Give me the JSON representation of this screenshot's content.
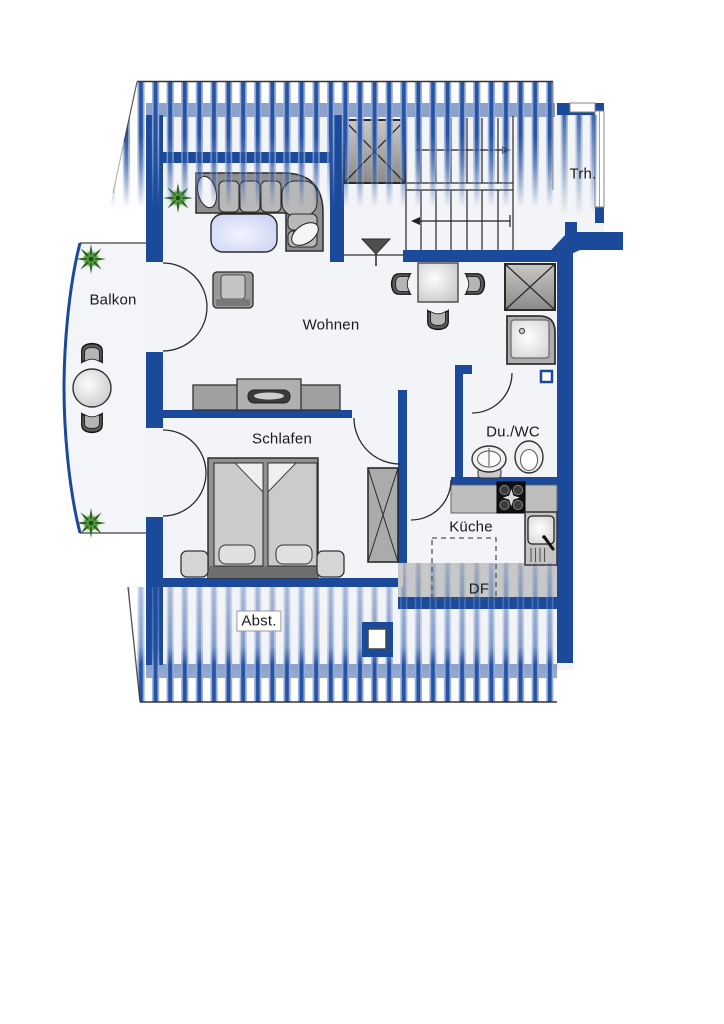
{
  "plan_type": "apartment-floor-plan",
  "labels": {
    "balcony": "Balkon",
    "living": "Wohnen",
    "sleeping": "Schlafen",
    "shower_wc": "Du./WC",
    "kitchen": "Küche",
    "stairwell": "Trh.",
    "storage": "Abst.",
    "roof_window": "DF"
  },
  "colors": {
    "wall": "#1b4a9b",
    "knee_wall": "rgba(27,74,155,0.48)",
    "hatch_core": "#2653a3",
    "hatch_edge": "#93a9d6",
    "floor": "#f3f4f7",
    "outline": "#333333",
    "furniture_gray": "#a8a8a8",
    "coffee_table": "#c9cdf2",
    "plant_green": "#3f8a2e"
  },
  "stairs": {
    "flights": 2,
    "up_arrow_direction": "right",
    "down_arrow_direction": "left"
  },
  "furniture": [
    "corner-sofa",
    "coffee-table",
    "potted-plant",
    "armchair",
    "tv-sideboard",
    "dining-table",
    "dining-chairs",
    "double-bed",
    "nightstands",
    "wardrobe",
    "shower-tray",
    "washbasin",
    "toilet",
    "stove",
    "kitchen-sink",
    "kitchen-counter",
    "balcony-table",
    "balcony-chairs",
    "chimney",
    "entrance-marker",
    "vent-shaft"
  ]
}
